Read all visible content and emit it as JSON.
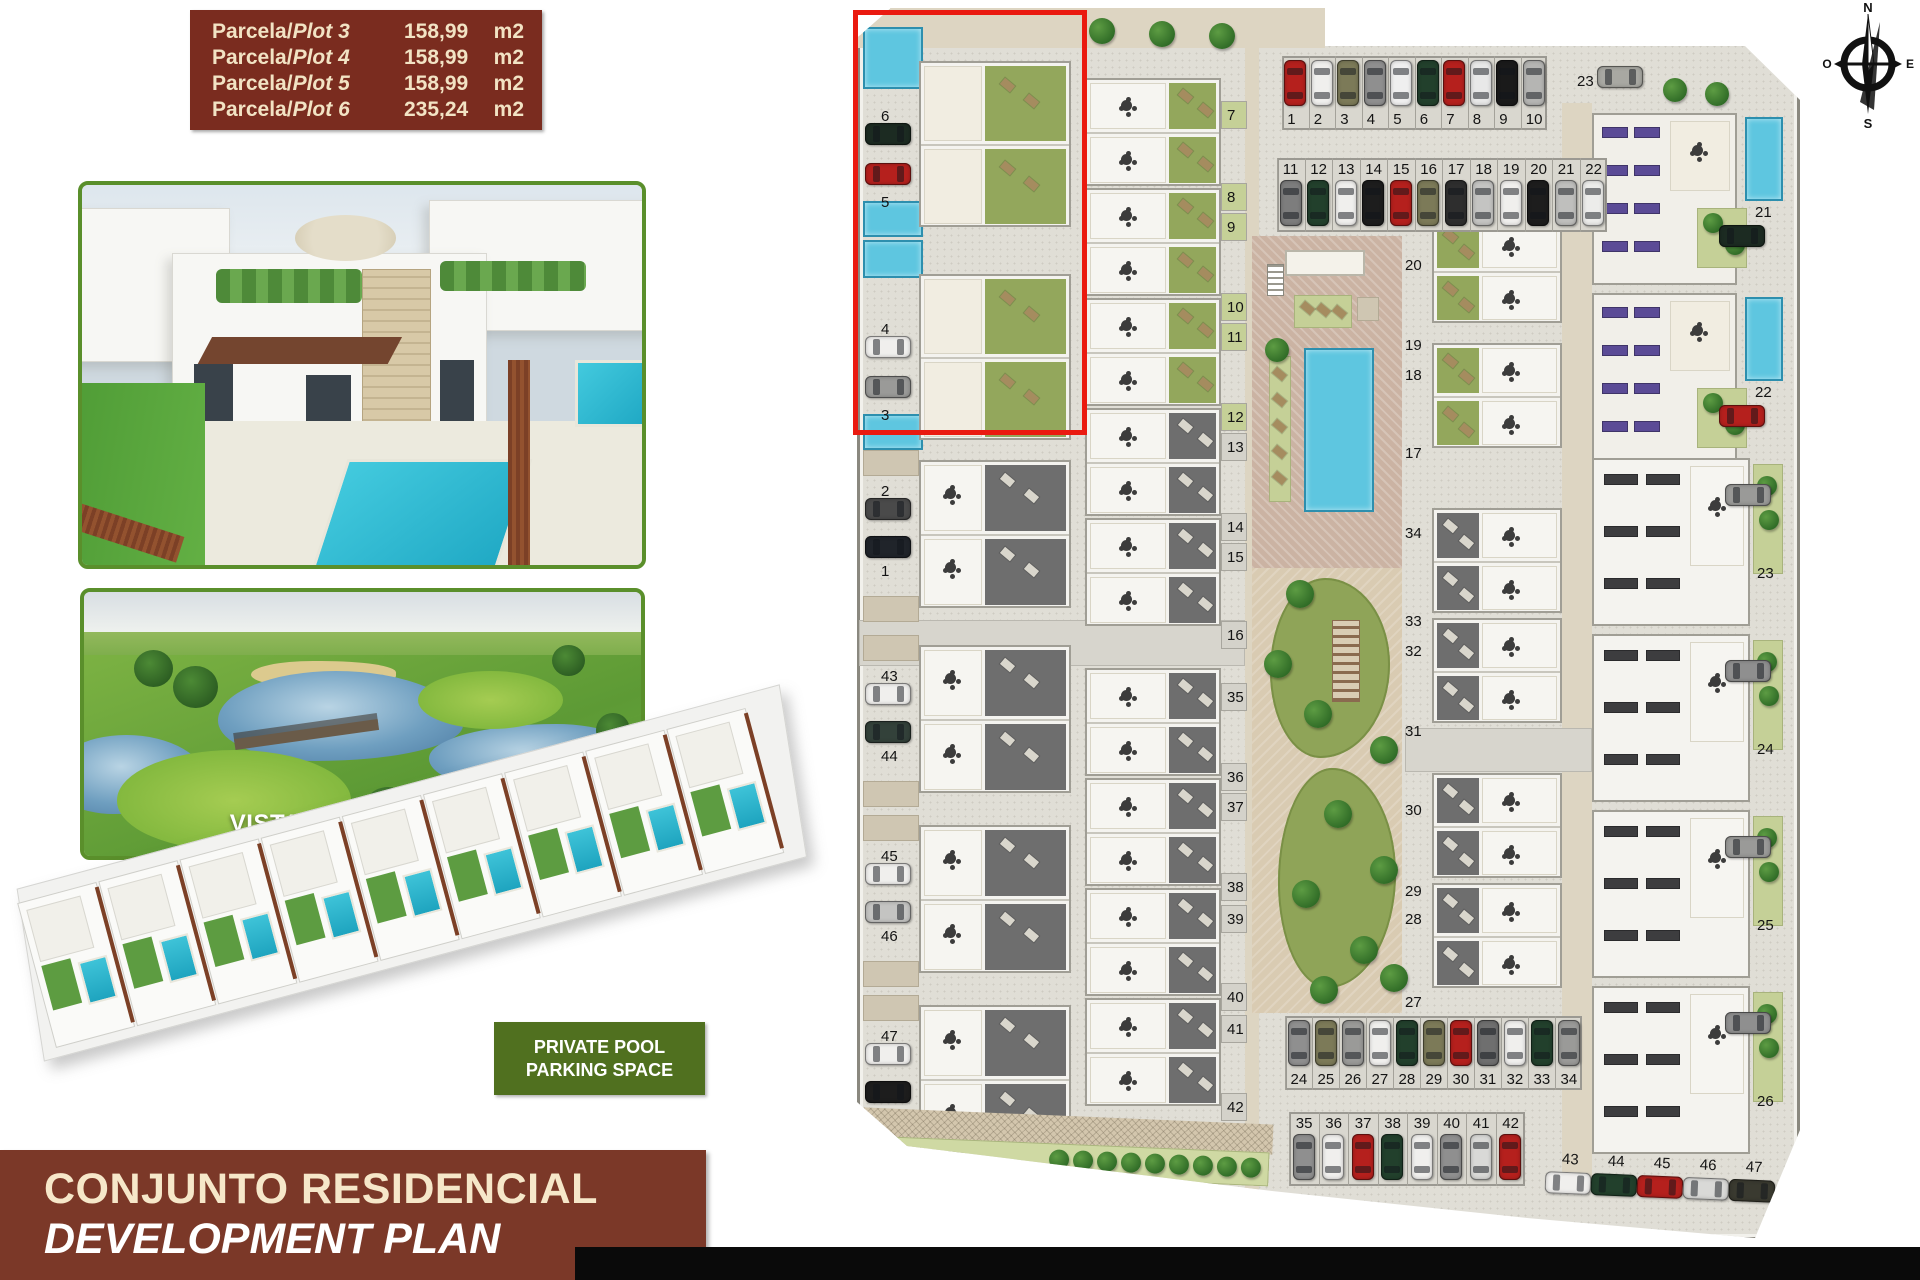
{
  "plot_info": {
    "rows": [
      {
        "prefix": "Parcela/",
        "plot": "Plot 3",
        "area": "158,99",
        "unit": "m2"
      },
      {
        "prefix": "Parcela/",
        "plot": "Plot 4",
        "area": "158,99",
        "unit": "m2"
      },
      {
        "prefix": "Parcela/",
        "plot": "Plot 5",
        "area": "158,99",
        "unit": "m2"
      },
      {
        "prefix": "Parcela/",
        "plot": "Plot 6",
        "area": "235,24",
        "unit": "m2"
      }
    ]
  },
  "photos": {
    "golf_label": "VISTABELLA GOLF"
  },
  "features_box": {
    "lines": [
      "PRIVATE POOL",
      "PARKING SPACE"
    ]
  },
  "title": {
    "line1": "CONJUNTO RESIDENCIAL",
    "line2": "DEVELOPMENT PLAN"
  },
  "compass": {
    "north": "N",
    "south": "S",
    "east": "E",
    "west": "O"
  },
  "colors": {
    "accent_red": "#ea1a10",
    "info_brown": "#7a2c1f",
    "banner_brown": "#7b3828",
    "features_green": "#50701f",
    "photo_border_green": "#5a8f2b",
    "pool_blue": "#5ec6e0",
    "lawn_green": "#93a75c",
    "terrace_gray": "#6e6e6e",
    "solar_purple": "#5b4b96"
  },
  "site_plan": {
    "left_plots": [
      {
        "number": "6",
        "car": "#1c2b22",
        "style": "green"
      },
      {
        "number": "5",
        "car": "#b5201d",
        "style": "green"
      },
      {
        "number": "4",
        "car": "#f0efed",
        "style": "green"
      },
      {
        "number": "3",
        "car": "#9a9a98",
        "style": "green"
      },
      {
        "number": "2",
        "car": "#4a4a4a",
        "style": "gray"
      },
      {
        "number": "1",
        "car": "#20242a",
        "style": "gray"
      },
      {
        "number": "43",
        "car": "#f0efed",
        "style": "gray"
      },
      {
        "number": "44",
        "car": "#33413a",
        "style": "gray"
      },
      {
        "number": "45",
        "car": "#f0efed",
        "style": "gray"
      },
      {
        "number": "46",
        "car": "#c4c4c2",
        "style": "gray"
      },
      {
        "number": "47",
        "car": "#f0efed",
        "style": "gray"
      },
      {
        "number": "48",
        "car": "#1d1d1d",
        "style": "gray"
      }
    ],
    "col2_numbers": [
      "7",
      "8",
      "9",
      "10",
      "11",
      "12",
      "13",
      "14",
      "15",
      "16",
      "35",
      "36",
      "37",
      "38",
      "39",
      "40",
      "41",
      "42"
    ],
    "col3_numbers": [
      "20",
      "19",
      "18",
      "17",
      "34",
      "33",
      "32",
      "31",
      "30",
      "29",
      "28",
      "27"
    ],
    "col4_top": [
      {
        "number": "21",
        "car": "#1c2b22"
      },
      {
        "number": "22",
        "car": "#b5201d"
      }
    ],
    "col4_bottom": [
      {
        "number": "23",
        "car": "#9a9a98"
      },
      {
        "number": "24",
        "car": "#8f8f8f"
      },
      {
        "number": "25",
        "car": "#9a9a98"
      },
      {
        "number": "26",
        "car": "#8f8f8f"
      }
    ],
    "parking": {
      "row_a": {
        "numbers": [
          "1",
          "2",
          "3",
          "4",
          "5",
          "6",
          "7",
          "8",
          "9",
          "10"
        ],
        "cars": [
          "#b5201d",
          "#f0efed",
          "#7c7a58",
          "#8f8f8f",
          "#efefef",
          "#22402c",
          "#b5201d",
          "#e8e8e8",
          "#1a1a1a",
          "#b5b5b3"
        ]
      },
      "row_b": {
        "numbers": [
          "11",
          "12",
          "13",
          "14",
          "15",
          "16",
          "17",
          "18",
          "19",
          "20",
          "21",
          "22"
        ],
        "cars": [
          "#7d7d7d",
          "#22402c",
          "#f0efed",
          "#1d1d1d",
          "#b5201d",
          "#7c7a58",
          "#2e2e2e",
          "#c4c4c2",
          "#f0efed",
          "#1d1d1d",
          "#bfbfbd",
          "#ececea"
        ]
      },
      "spot_23": {
        "number": "23",
        "car": "#a8a8a2"
      },
      "row_c": {
        "numbers": [
          "24",
          "25",
          "26",
          "27",
          "28",
          "29",
          "30",
          "31",
          "32",
          "33",
          "34"
        ],
        "cars": [
          "#8f8f8f",
          "#7c7a58",
          "#9a9a98",
          "#f0efed",
          "#22402c",
          "#7c7a58",
          "#b5201d",
          "#6f6f6f",
          "#f0efed",
          "#22402c",
          "#9a9a98"
        ]
      },
      "row_d": {
        "numbers": [
          "35",
          "36",
          "37",
          "38",
          "39",
          "40",
          "41",
          "42"
        ],
        "cars": [
          "#8f8f8f",
          "#f0efed",
          "#b5201d",
          "#22402c",
          "#f0efed",
          "#8f8f8f",
          "#d9d9d7",
          "#b5201d"
        ]
      },
      "row_e": {
        "numbers": [
          "43",
          "44",
          "45",
          "46",
          "47"
        ],
        "cars": [
          "#f0efed",
          "#22402c",
          "#b5201d",
          "#d9d9d7",
          "#3a3a30"
        ]
      }
    }
  }
}
